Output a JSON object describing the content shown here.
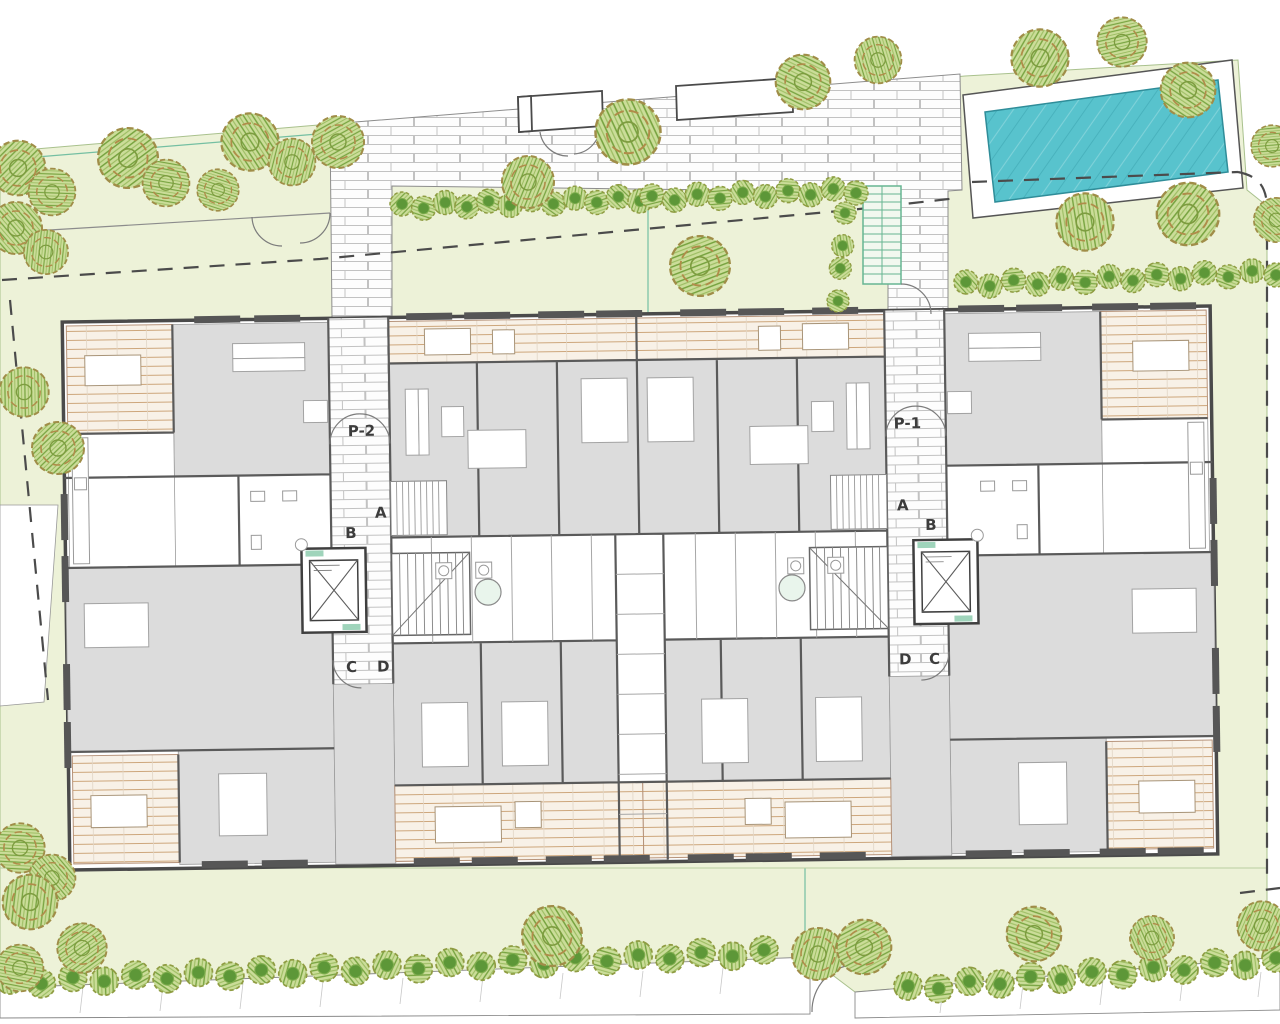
{
  "plan_labels": {
    "entrance_left": "P-2",
    "entrance_right": "P-1",
    "core_left": {
      "a": "A",
      "b": "B",
      "c": "C",
      "d": "D"
    },
    "core_right": {
      "a": "A",
      "b": "B",
      "c": "C",
      "d": "D"
    }
  },
  "colors": {
    "lawn": "#edf2d8",
    "lawn_line": "#a9c18d",
    "pool_water": "#58c3cd",
    "pool_edge": "#2f8d99",
    "deck_base": "#f8f1e7",
    "deck_line": "#cda67b",
    "room_fill": "#dcdcdc",
    "wall": "#4a4a4a",
    "boundary": "#4b4b4b",
    "brick_line": "#c2c2c2",
    "accent_green": "#66b592",
    "tree_outline": "#a08d48",
    "tree_leaf": "#cbdd99",
    "tree_hatch": "#78a441",
    "bush_core": "#5d9738"
  },
  "landscape": {
    "trees": [
      [
        18,
        168,
        1.05
      ],
      [
        52,
        192,
        0.9
      ],
      [
        16,
        228,
        1.0
      ],
      [
        46,
        252,
        0.85
      ],
      [
        128,
        158,
        1.15
      ],
      [
        166,
        183,
        0.9
      ],
      [
        250,
        142,
        1.1
      ],
      [
        292,
        162,
        0.9
      ],
      [
        338,
        142,
        1.0
      ],
      [
        218,
        190,
        0.8
      ],
      [
        628,
        132,
        1.25
      ],
      [
        528,
        182,
        1.0
      ],
      [
        700,
        266,
        1.15
      ],
      [
        803,
        82,
        1.05
      ],
      [
        878,
        60,
        0.9
      ],
      [
        1040,
        58,
        1.1
      ],
      [
        1122,
        42,
        0.95
      ],
      [
        1188,
        90,
        1.05
      ],
      [
        1085,
        222,
        1.1
      ],
      [
        1188,
        214,
        1.2
      ],
      [
        1272,
        146,
        0.8
      ],
      [
        1276,
        220,
        0.85
      ],
      [
        24,
        392,
        0.95
      ],
      [
        58,
        448,
        1.0
      ],
      [
        20,
        848,
        0.95
      ],
      [
        52,
        878,
        0.9
      ],
      [
        30,
        902,
        1.05
      ],
      [
        82,
        948,
        0.95
      ],
      [
        20,
        968,
        0.9
      ],
      [
        552,
        936,
        1.15
      ],
      [
        818,
        954,
        1.0
      ],
      [
        864,
        947,
        1.05
      ],
      [
        1034,
        934,
        1.05
      ],
      [
        1152,
        938,
        0.85
      ],
      [
        1262,
        926,
        0.95
      ]
    ],
    "hedges": [
      {
        "x1": 402,
        "y1": 206,
        "x2": 640,
        "y2": 198,
        "n": 12,
        "r": 12
      },
      {
        "x1": 652,
        "y1": 198,
        "x2": 856,
        "y2": 190,
        "n": 10,
        "r": 12
      },
      {
        "x1": 845,
        "y1": 215,
        "x2": 838,
        "y2": 298,
        "n": 4,
        "r": 11
      },
      {
        "x1": 966,
        "y1": 284,
        "x2": 1276,
        "y2": 272,
        "n": 14,
        "r": 12
      },
      {
        "x1": 10,
        "y1": 982,
        "x2": 764,
        "y2": 952,
        "n": 25,
        "r": 14
      },
      {
        "x1": 908,
        "y1": 988,
        "x2": 1276,
        "y2": 960,
        "n": 13,
        "r": 14
      }
    ]
  }
}
